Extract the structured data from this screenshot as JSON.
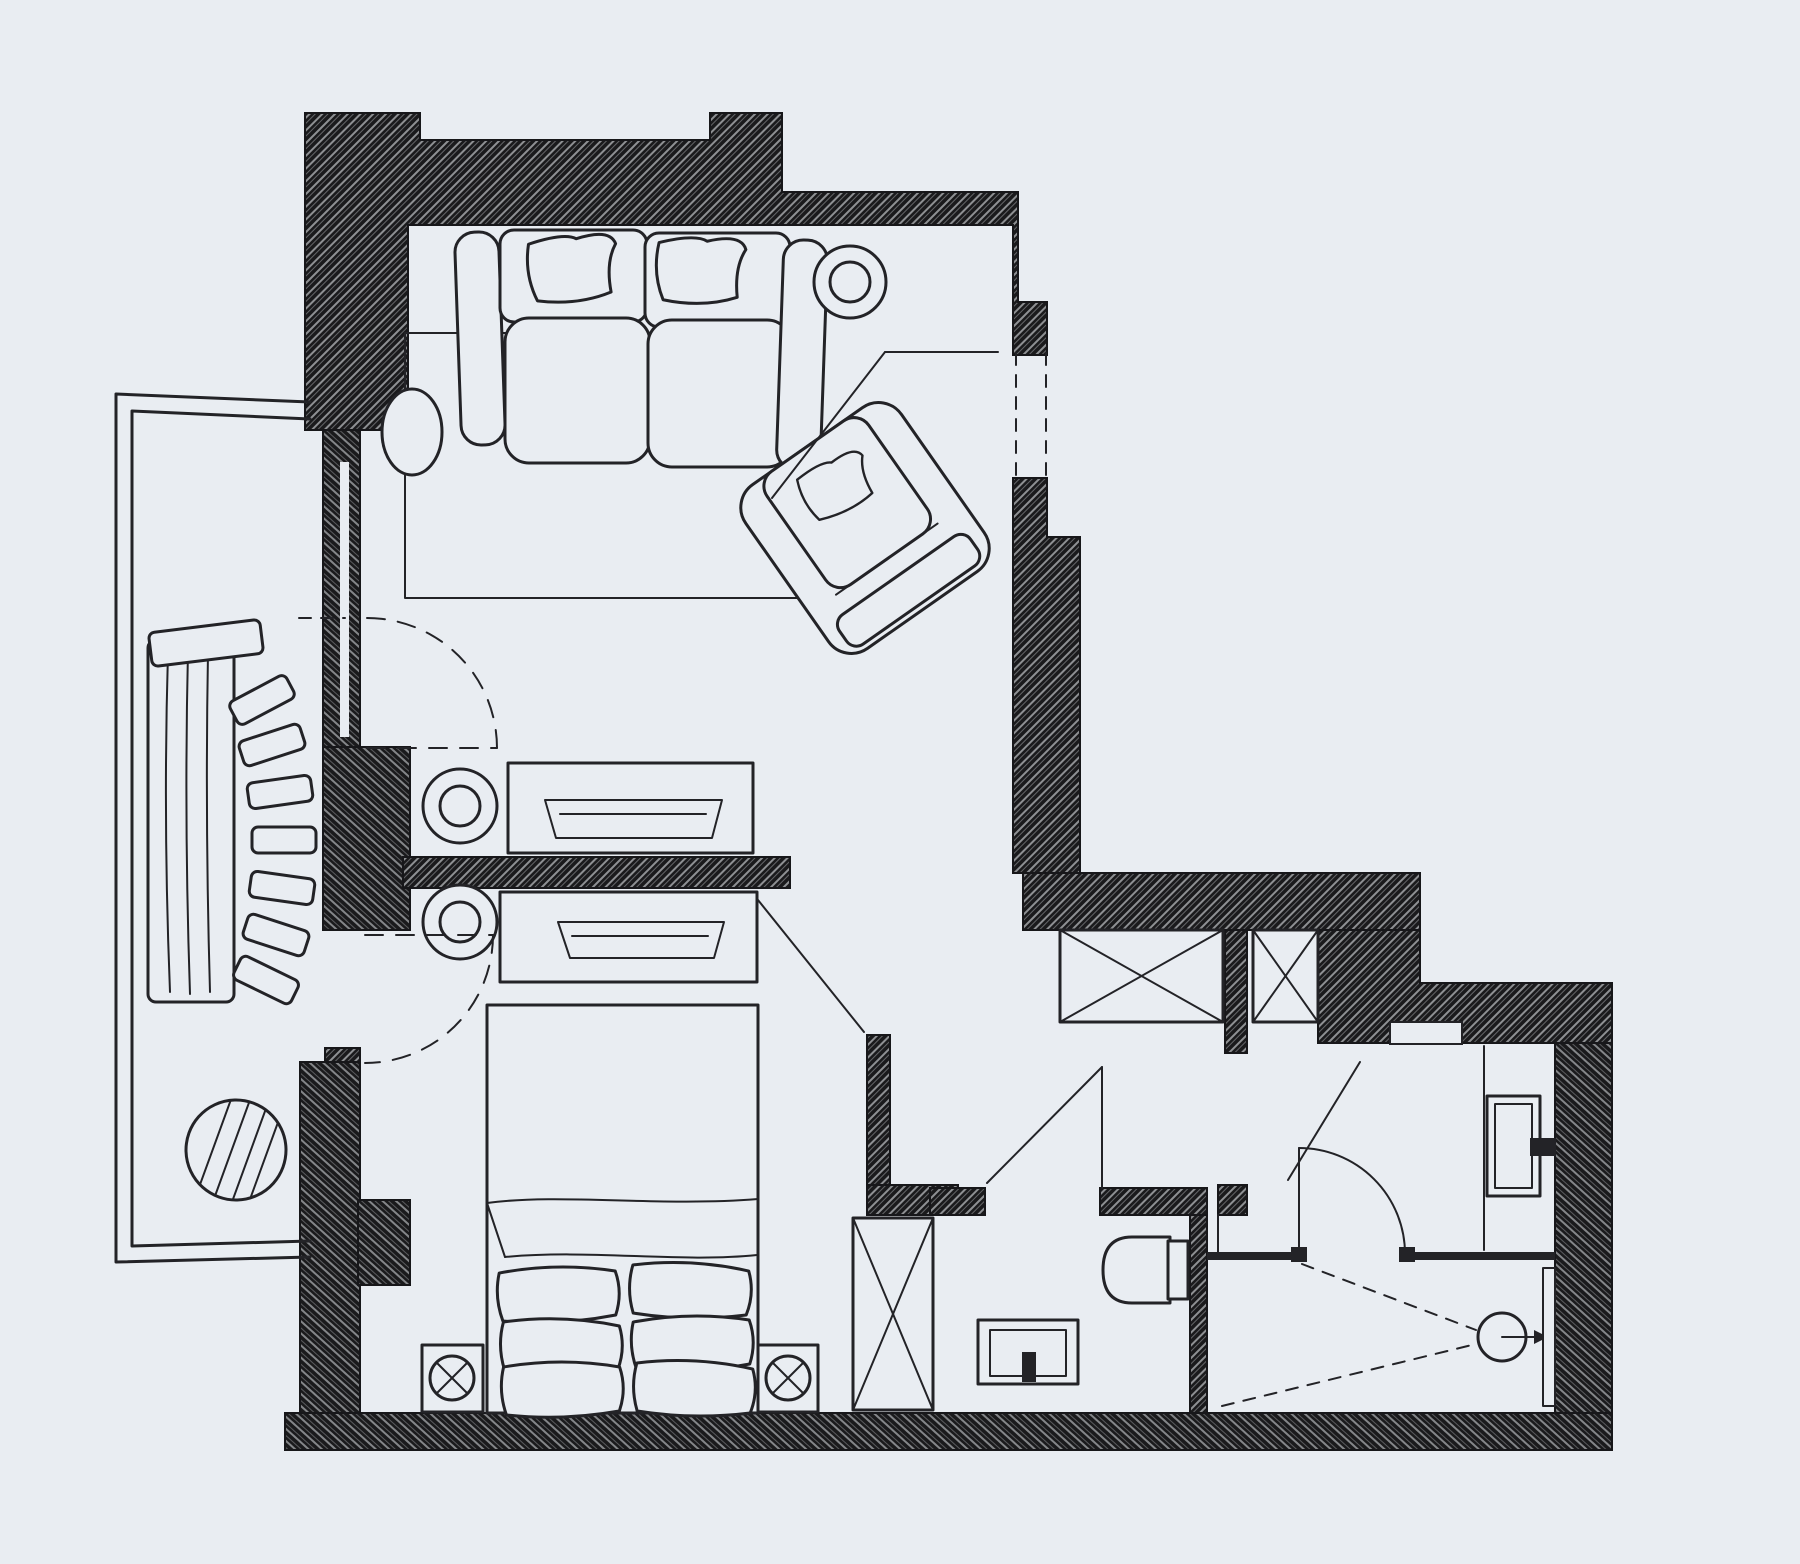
{
  "meta": {
    "artwork": "hand-drawn apartment floor plan",
    "style": "black ink sketch on cool gray paper",
    "text_labels": []
  },
  "canvas": {
    "width": 1800,
    "height": 1564
  },
  "colors": {
    "background": "#e9edf2",
    "ink": "#232327",
    "wall_fill": "#1a1a1c",
    "wall_hatch_line": "#edf1f5"
  },
  "elements": {
    "structure": [
      "exterior-hatched-walls",
      "interior-partitions",
      "balcony-railing",
      "window-glazing-strip",
      "dashed-window-opening",
      "threshold-notch"
    ],
    "living_room": [
      "three-seat-sofa",
      "sofa-throw-pillow-left",
      "sofa-throw-pillow-right",
      "round-side-table",
      "oval-side-table",
      "area-rug",
      "armchair",
      "armchair-throw-pillow",
      "media-console-living",
      "serving-tray-living",
      "round-stool-living",
      "balcony-door-open-leaf",
      "balcony-door-dashed-swing"
    ],
    "bedroom": [
      "double-bed",
      "blanket-fold",
      "bed-pillows-six",
      "nightstand-left",
      "nightstand-right",
      "lamp-symbol-left",
      "lamp-symbol-right",
      "media-console-bedroom",
      "serving-tray-bedroom",
      "round-stool-bedroom",
      "wardrobe-x-box",
      "balcony-door-dashed-swing",
      "interior-door-leaf"
    ],
    "hall": [
      "closet-x-wide",
      "closet-x-narrow",
      "entry-door-leaf",
      "vanity-door-leaf"
    ],
    "bathroom": [
      "toilet",
      "wall-sink-with-tap",
      "doorway-gap"
    ],
    "shower_room": [
      "vanity-sink-with-tap",
      "counter-edge-line",
      "door-swing-arc",
      "door-hinge-stubs",
      "glass-partition-lines",
      "shower-spray-dashed-lines",
      "shower-head-circle",
      "shower-arrow",
      "shower-glass-panel"
    ],
    "balcony": [
      "lounge-chair",
      "lounge-back-slats",
      "slatted-round-table"
    ]
  }
}
